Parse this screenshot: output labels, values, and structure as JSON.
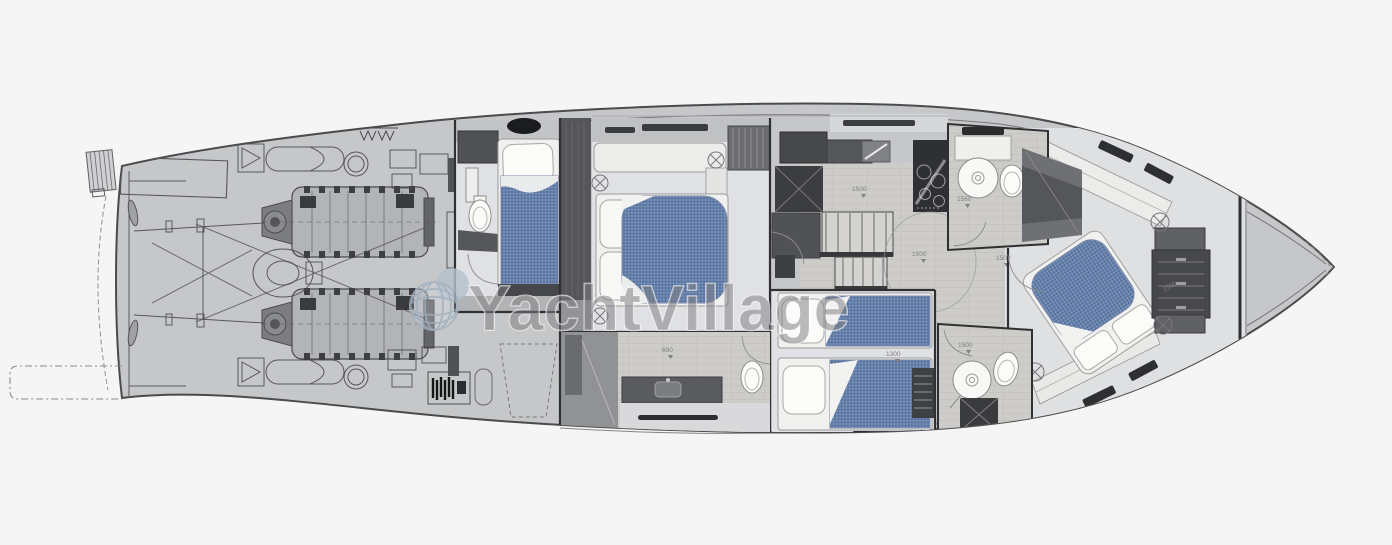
{
  "watermark": {
    "icon": "globe-icon",
    "text": "YachtVillage"
  },
  "dimension_labels": {
    "galley": "1500",
    "hallway": "1500",
    "twin_cabin": "1300",
    "master_bathroom": "690",
    "vip_bathroom": "1560",
    "vip_cabin_aft": "1500",
    "vip_cabin_fwd": "1500",
    "day_head": "1500"
  },
  "colors": {
    "background": "#f5f5f6",
    "hull": "#c6c7c8",
    "hull_outline": "#4a4b4d",
    "wall": "#2f3032",
    "floor_light": "#e0e1e4",
    "floor_wood": "#cdccc9",
    "furniture_dark": "#515256",
    "furniture_black": "#2c2d2f",
    "mattress_blue": "#54719f",
    "linen_white": "#f4f4f2",
    "watermark_text": "#7f7f82",
    "watermark_globe": "#a3b2c0",
    "dimension_label": "#7f7f84"
  }
}
